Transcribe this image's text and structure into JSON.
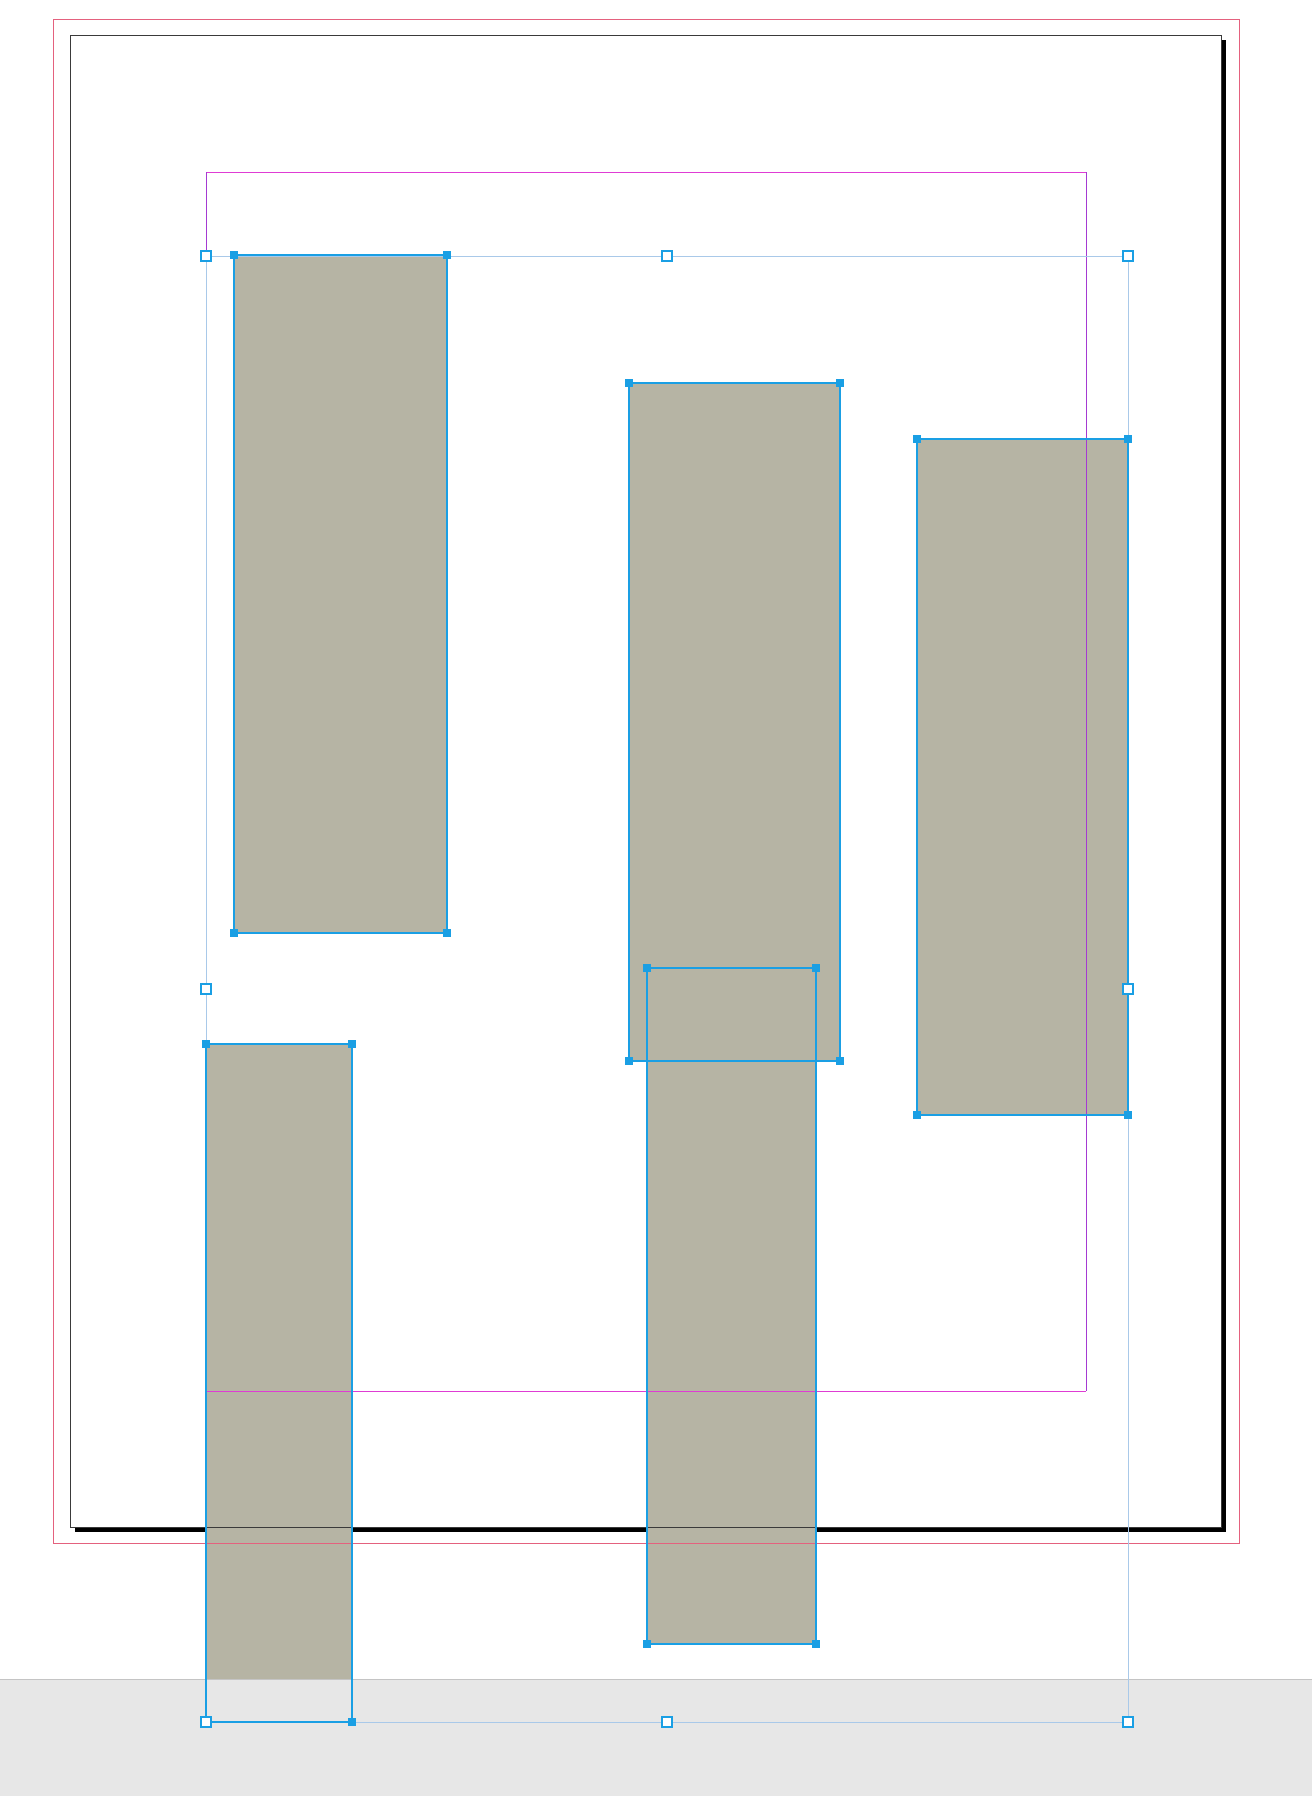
{
  "app": {
    "view": "layout-canvas",
    "description": "page layout canvas with five selected rectangular frames"
  },
  "colors": {
    "canvas_bg": "#ffffff",
    "band_fill": "#e7e7e7",
    "band_edge": "#c4c4c4",
    "page_fill": "#ffffff",
    "page_border": "#3a3a3a",
    "page_shadow": "#000000",
    "bleed_guide": "#e4617e",
    "margin_guide": "#df3cd4",
    "column_guide": "#a53ad2",
    "frame_fill": "#b6b4a4",
    "frame_stroke": "#1a9fe4",
    "selection_line": "#a9c9e9",
    "handle_fill": "#1a9fe4",
    "handle_hollow_fill": "#ffffff"
  },
  "page": {
    "x": 70,
    "y": 35,
    "w": 1151,
    "h": 1492,
    "shadow_offset": 5
  },
  "bleed": {
    "x": 53,
    "y": 19,
    "w": 1186,
    "h": 1524
  },
  "margins": {
    "x": 206,
    "y": 172,
    "w": 880,
    "h": 1219
  },
  "pasteboard_band": {
    "y": 1679,
    "h": 117
  },
  "frames": [
    {
      "id": "frame-1",
      "x": 234,
      "y": 255,
      "w": 213,
      "h": 678
    },
    {
      "id": "frame-2",
      "x": 629,
      "y": 383,
      "w": 211,
      "h": 678
    },
    {
      "id": "frame-3",
      "x": 917,
      "y": 439,
      "w": 211,
      "h": 676
    },
    {
      "id": "frame-4",
      "x": 647,
      "y": 968,
      "w": 169,
      "h": 676
    },
    {
      "id": "frame-5",
      "x": 206,
      "y": 1044,
      "w": 146,
      "h": 678
    }
  ],
  "selection": {
    "x": 206,
    "y": 256,
    "w": 922,
    "h": 1466
  },
  "handle_sizes": {
    "frame_corner": 8,
    "bounding_hollow": 12
  }
}
